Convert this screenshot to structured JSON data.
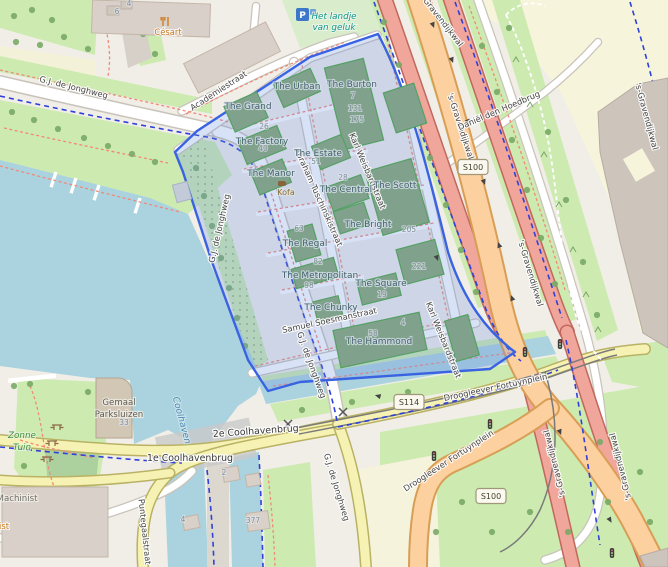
{
  "app": "slippy-map-viewport",
  "colors": {
    "land": "#f1eee8",
    "water": "#aad3df",
    "grass": "#cdebb0",
    "scrub_green": "#add19e",
    "pale_yellow": "#f6f5dc",
    "building_out": "#d9d0c9",
    "building_in": "#80a28c",
    "building_in_stroke": "#55a065",
    "road_primary": "#fcd09f",
    "road_trunk": "#f0a69b",
    "road_secondary": "#f6f2b4",
    "road_white": "#ffffff",
    "highlight_border": "#3a63e2",
    "highlight_fill": "rgba(106,144,225,0.26)",
    "cycle_route": "#2f41d8",
    "foot_path": "#f08a78"
  },
  "highlighted_area": {
    "name": "Little C development polygon",
    "border_color": "#3a63e2"
  },
  "street_labels": [
    {
      "text": "G.J. de Jonghweg",
      "x": 73,
      "y": 90,
      "rot": 14,
      "cls": "st"
    },
    {
      "text": "Academiestraat",
      "x": 220,
      "y": 93,
      "rot": -33,
      "cls": "st"
    },
    {
      "text": "Abraham Tuschinskistraat",
      "x": 316,
      "y": 198,
      "rot": 66,
      "cls": "st"
    },
    {
      "text": "Karl Weisbardstraat",
      "x": 365,
      "y": 172,
      "rot": 67,
      "cls": "st"
    },
    {
      "text": "Karl Weisbardstraat",
      "x": 441,
      "y": 341,
      "rot": 68,
      "cls": "st"
    },
    {
      "text": "Samuel Soesmanstraat",
      "x": 330,
      "y": 323,
      "rot": -12,
      "cls": "st"
    },
    {
      "text": "G.J. de Jonghweg",
      "x": 222,
      "y": 229,
      "rot": -77,
      "cls": "st"
    },
    {
      "text": "G.J. de Jonghweg",
      "x": 309,
      "y": 366,
      "rot": 70,
      "cls": "st"
    },
    {
      "text": "G.J. de Jonghweg",
      "x": 334,
      "y": 488,
      "rot": 73,
      "cls": "st"
    },
    {
      "text": "'s-Gravendijkwal",
      "x": 438,
      "y": 20,
      "rot": 52,
      "cls": "st"
    },
    {
      "text": "'s-Gravendijkwal",
      "x": 458,
      "y": 127,
      "rot": 72,
      "cls": "st"
    },
    {
      "text": "'s-Gravendijkwal",
      "x": 528,
      "y": 274,
      "rot": 73,
      "cls": "st"
    },
    {
      "text": "'s-Gravendijkwal",
      "x": 644,
      "y": 117,
      "rot": 75,
      "cls": "st"
    },
    {
      "text": "'s-Gravendijkwal",
      "x": 557,
      "y": 463,
      "rot": -104,
      "cls": "st"
    },
    {
      "text": "'s-Gravendijkwal",
      "x": 623,
      "y": 466,
      "rot": -104,
      "cls": "st"
    },
    {
      "text": "Daniël den Hoedbrug",
      "x": 500,
      "y": 113,
      "rot": -23,
      "cls": "st"
    },
    {
      "text": "Droogleever Fortuynplein",
      "x": 496,
      "y": 390,
      "rot": -12,
      "cls": "st"
    },
    {
      "text": "Droogleever Fortuynplein",
      "x": 450,
      "y": 463,
      "rot": -33,
      "cls": "st"
    },
    {
      "text": "2e Coolhavenbrug",
      "x": 256,
      "y": 434,
      "rot": -4,
      "cls": "big"
    },
    {
      "text": "1e Coolhavenbrug",
      "x": 190,
      "y": 461,
      "rot": 0,
      "cls": "big"
    },
    {
      "text": "Puntegaalstraat",
      "x": 142,
      "y": 532,
      "rot": 84,
      "cls": "st"
    }
  ],
  "water_labels": [
    {
      "text": "Coolhaven",
      "x": 179,
      "y": 421,
      "rot": 75
    }
  ],
  "area_labels": [
    {
      "lines": [
        "Het landje",
        "van geluk"
      ],
      "x": 334,
      "y": 19,
      "cls": "teal",
      "lh": 11
    },
    {
      "lines": [
        "Zonne",
        "Tuin"
      ],
      "x": 22,
      "y": 438,
      "cls": "green",
      "lh": 12
    },
    {
      "lines": [
        "Gemaal",
        "Parksluizen"
      ],
      "x": 119,
      "y": 405,
      "cls": "grey",
      "lh": 12
    },
    {
      "lines": [
        "Machinist"
      ],
      "x": 17,
      "y": 501,
      "cls": "grey2",
      "lh": 12
    },
    {
      "lines": [
        "ist"
      ],
      "x": 4,
      "y": 529,
      "cls": "orange",
      "lh": 12
    }
  ],
  "building_labels": [
    {
      "name": "The Grand",
      "x": 248,
      "y": 109
    },
    {
      "name": "The Urban",
      "x": 297,
      "y": 89
    },
    {
      "name": "The Burton",
      "x": 352,
      "y": 87
    },
    {
      "name": "The Factory",
      "x": 262,
      "y": 144
    },
    {
      "name": "The Estate",
      "x": 318,
      "y": 156
    },
    {
      "name": "The Manor",
      "x": 271,
      "y": 176
    },
    {
      "name": "The Central",
      "x": 346,
      "y": 192
    },
    {
      "name": "The Scott",
      "x": 395,
      "y": 188
    },
    {
      "name": "The Bright",
      "x": 368,
      "y": 227
    },
    {
      "name": "The Regal",
      "x": 305,
      "y": 246
    },
    {
      "name": "The Metropolitan",
      "x": 320,
      "y": 278
    },
    {
      "name": "The Square",
      "x": 381,
      "y": 286
    },
    {
      "name": "The Chunky",
      "x": 331,
      "y": 310
    },
    {
      "name": "The Hammond",
      "x": 379,
      "y": 344
    }
  ],
  "house_numbers": [
    {
      "text": "26",
      "x": 264,
      "y": 129
    },
    {
      "text": "40",
      "x": 263,
      "y": 151
    },
    {
      "text": "51",
      "x": 316,
      "y": 164
    },
    {
      "text": "7",
      "x": 353,
      "y": 98
    },
    {
      "text": "131",
      "x": 355,
      "y": 111
    },
    {
      "text": "175",
      "x": 357,
      "y": 122
    },
    {
      "text": "28",
      "x": 343,
      "y": 180
    },
    {
      "text": "205",
      "x": 409,
      "y": 232
    },
    {
      "text": "63",
      "x": 299,
      "y": 231
    },
    {
      "text": "82",
      "x": 318,
      "y": 264
    },
    {
      "text": "98",
      "x": 309,
      "y": 288
    },
    {
      "text": "19",
      "x": 382,
      "y": 297
    },
    {
      "text": "221",
      "x": 419,
      "y": 269
    },
    {
      "text": "58",
      "x": 373,
      "y": 336
    },
    {
      "text": "4",
      "x": 403,
      "y": 325
    },
    {
      "text": "33",
      "x": 124,
      "y": 425
    },
    {
      "text": "2",
      "x": 224,
      "y": 475
    },
    {
      "text": "377",
      "x": 253,
      "y": 523
    },
    {
      "text": "4",
      "x": 183,
      "y": 522
    },
    {
      "text": "6",
      "x": 117,
      "y": 14
    },
    {
      "text": "4",
      "x": 129,
      "y": 6
    }
  ],
  "road_shields": [
    {
      "text": "S100",
      "x": 473,
      "y": 167
    },
    {
      "text": "S114",
      "x": 409,
      "y": 402
    },
    {
      "text": "S100",
      "x": 491,
      "y": 496
    }
  ],
  "pois": [
    {
      "name": "Césart",
      "type": "restaurant",
      "icon_x": 163,
      "icon_y": 17,
      "label_x": 168,
      "label_y": 35
    },
    {
      "name": "Kofa",
      "type": "cafe",
      "icon_x": 278,
      "icon_y": 181,
      "label_x": 286,
      "label_y": 195
    },
    {
      "name": "P",
      "type": "parking",
      "icon_x": 296,
      "icon_y": 8
    }
  ],
  "map_symbols": {
    "picnic_tables": [
      [
        57,
        425
      ],
      [
        52,
        441
      ],
      [
        47,
        457
      ]
    ],
    "traffic_signals": [
      [
        525,
        352
      ],
      [
        560,
        344
      ],
      [
        490,
        424
      ],
      [
        434,
        456
      ],
      [
        612,
        553
      ]
    ],
    "level_crossings": [
      [
        288,
        424
      ],
      [
        343,
        412
      ]
    ]
  }
}
